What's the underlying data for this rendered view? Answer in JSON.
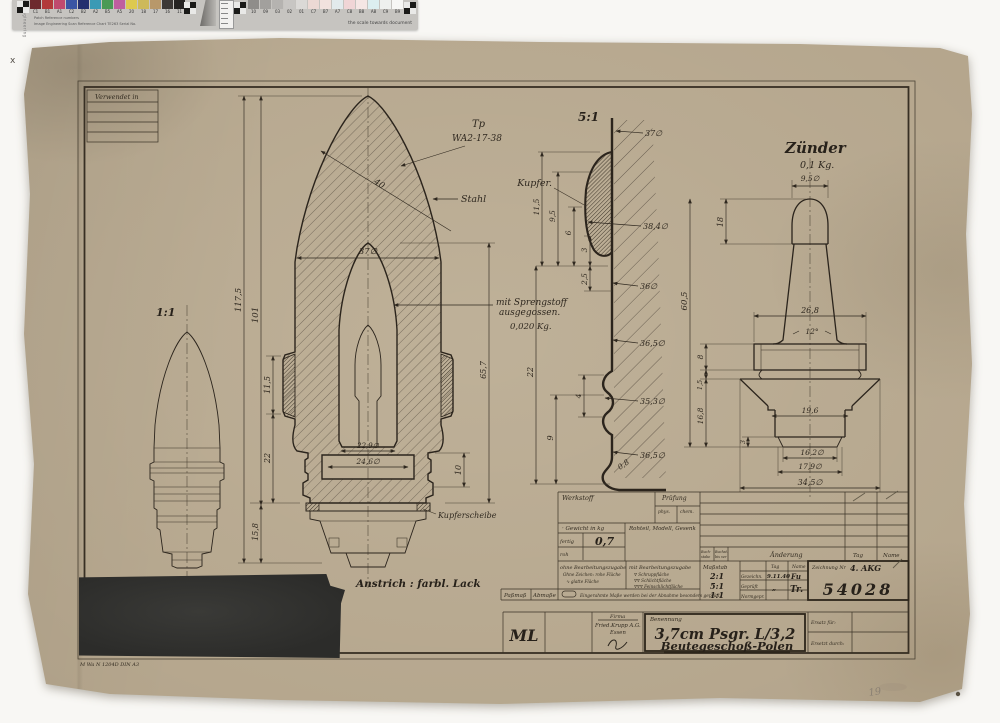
{
  "calibration": {
    "left": {
      "labels": [
        "C1",
        "B1",
        "A1",
        "C2",
        "B2",
        "A2",
        "B5",
        "A5",
        "20",
        "18",
        "17",
        "16",
        "11"
      ],
      "colors": [
        "#6d2a2e",
        "#b23a3a",
        "#c04a6e",
        "#3a55a4",
        "#252f6e",
        "#3a9ab5",
        "#4a9a55",
        "#bf5f9f",
        "#ddc94f",
        "#cdb95a",
        "#b8986a",
        "#3c3835",
        "#262422"
      ]
    },
    "right": {
      "labels": [
        "10",
        "09",
        "03",
        "02",
        "01",
        "C7",
        "B7",
        "A7",
        "C8",
        "B8",
        "A8",
        "C9",
        "B9"
      ],
      "colors": [
        "#8f8d8a",
        "#a2a09d",
        "#b5b3b0",
        "#c8c6c3",
        "#dbd9d6",
        "#ecd9d4",
        "#f1e2de",
        "#e2eaec",
        "#f0d5d6",
        "#f5e6e4",
        "#dceef0",
        "#eef0ee",
        "#f7f7f5"
      ]
    },
    "note": "the scale towards document",
    "fineprint": "Patch Reference numbers",
    "maker_line": "Image Engineering   Scan Reference Chart   TE263   Serial No.",
    "edge_text": "Image Engineering"
  },
  "drawing": {
    "verwendet_in": "Verwendet in",
    "scale_small": "1:1",
    "scale_detail": "5:1",
    "ann": {
      "tp1": "Tp",
      "tp2": "WA2-17-38",
      "stahl": "Stahl",
      "spreng1": "mit Sprengstoff",
      "spreng2": "ausgegossen.",
      "spreng3": "0,020 Kg.",
      "kupfer": "Kupfer.",
      "kupferscheibe": "Kupferscheibe",
      "anstrich": "Anstrich : farbl. Lack",
      "zuender": "Zünder",
      "zuender_kg": "0,1 Kg."
    },
    "dims_main": {
      "d117": "117,5",
      "d101": "101",
      "d40": "40",
      "d37": "37∅",
      "d115": "11,5",
      "d22": "22",
      "d158": "15,8",
      "d229": "22,9∅",
      "d246": "24,6∅",
      "d10": "10",
      "d657": "65,7"
    },
    "dims_detail": {
      "d37": "37∅",
      "d384": "38,4∅",
      "d36": "36∅",
      "d365a": "36,5∅",
      "d353": "35,3∅",
      "d365b": "36,5∅",
      "d08": "0,8",
      "d115": "11,5",
      "d95": "9,5",
      "d6": "6",
      "d3": "3",
      "d25": "2,5",
      "d22": "22",
      "d4": "4",
      "d9": "9"
    },
    "dims_fuze": {
      "d95": "9,5∅",
      "d18": "18",
      "d268": "26,8",
      "d12": "12°",
      "d605": "60,5",
      "d8": "8",
      "d15": "1,5",
      "d168": "16,8",
      "d3": "3",
      "d196": "19,6",
      "d162": "16,2∅",
      "d179": "17,9∅",
      "d345": "34,5∅"
    },
    "din_note": "M Wa N 1204D DIN A3",
    "pencil_note": "19",
    "registration_mark": "x"
  },
  "titleblock": {
    "werkstoff": "Werkstoff",
    "pruefung": "Prüfung",
    "phys": "phys.",
    "chem": "chem.",
    "gewicht": "· Gewicht in kg",
    "fertig": "fertig",
    "gewicht_fertig": "0,7",
    "roh": "roh",
    "rohteil": "Rohteil, Modell, Gesenk",
    "buchstabe1": "Buch-",
    "buchstabe2": "stabe",
    "buchst1": "Buchst.",
    "buchst2": "bis ver",
    "aenderung": "Änderung",
    "tag": "Tag",
    "name": "Name",
    "ohne1": "ohne Bearbeitungszugabe",
    "ohne2": "Ohne Zeichen: rohe Fläche",
    "ohne3": "∿  glatte Fläche",
    "mit1": "mit Bearbeitungszugabe",
    "mit2": "∇ Schruppfläche",
    "mit3": "∇∇ Schlichtfläche",
    "mit4": "∇∇∇ Feinschlichtfläche",
    "massstab": "Maßstab",
    "scale1": "2:1",
    "scale2": "5:1",
    "scale3": "1:1",
    "tag2": "Tag",
    "name2": "Name",
    "gezeichnet": "Gezeichn.",
    "gezeichnet_tag": "9.11.40",
    "gezeichnet_name": "Fu",
    "geprueft": "Geprüft",
    "geprueft_tag": "„",
    "geprueft_name": "Tr.",
    "normgepr": "Normgepr.",
    "zeichnung_label": "Zeichnung Nr",
    "zeichnung_code": "4. AKG",
    "zeichnung_nr": "54028",
    "passmass": "Paßmaß",
    "abmasse": "Abmaße",
    "eingerahmt": "Eingerahmte Maße werden bei der Abnahme besonders geprüft.",
    "ml": "ML",
    "firma_label": "Firma",
    "firma1": "Fried.Krupp A.G.",
    "firma2": "Essen",
    "benennung_label": "Benennung",
    "benennung1": "3,7cm  Psgr. L/3,2",
    "benennung2": "Beutegeschoß-Polen",
    "ersatz": "Ersatz für:",
    "ersetzt": "Ersetzt durch:"
  }
}
